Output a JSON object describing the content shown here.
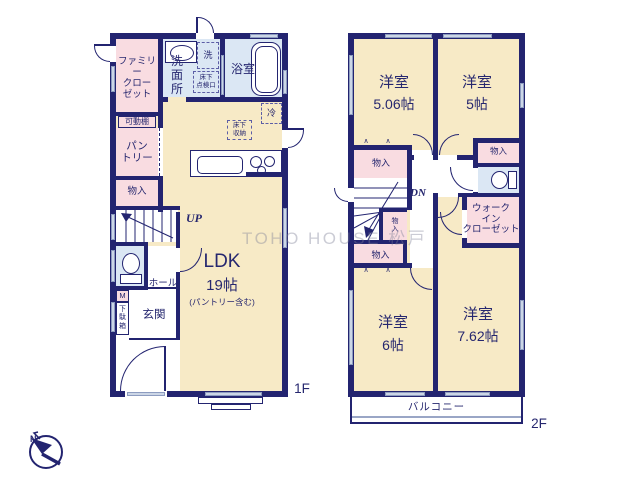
{
  "watermark": "TOHO HOUSE 松戸",
  "symbols": {
    "fold": "∧",
    "north": "N"
  },
  "f1": {
    "floor_label": "1F",
    "family_closet": "ファミリー\nクロー\nゼット",
    "movable_shelf": "可動棚",
    "pantry": "パン\nトリー",
    "storage": "物入",
    "washroom": "洗\n面\n所",
    "washer": "洗",
    "underfloor_hatch": "床下\n点検口",
    "bathroom": "浴室",
    "fridge": "冷",
    "underfloor_storage": "床下\n収納",
    "up": "UP",
    "hall": "ホール",
    "m_box": "M",
    "shoe_cabinet": "下\n駄\n箱",
    "entrance": "玄関",
    "ldk": "LDK",
    "ldk_size": "19帖",
    "ldk_note": "(パントリー含む)"
  },
  "f2": {
    "floor_label": "2F",
    "room_name": "洋室",
    "room1_size": "5.06帖",
    "room2_size": "5帖",
    "room3_size": "6帖",
    "room4_size": "7.62帖",
    "storage": "物入",
    "storage_vert": "物\n入",
    "dn": "DN",
    "walk_in_closet": "ウォーク\nイン\nクローゼット",
    "balcony": "バルコニー"
  },
  "colors": {
    "wall": "#232470",
    "cream": "#f7eac6",
    "pink": "#f9dce1",
    "blue": "#dbe7f4",
    "window": "#ccd6e6"
  }
}
